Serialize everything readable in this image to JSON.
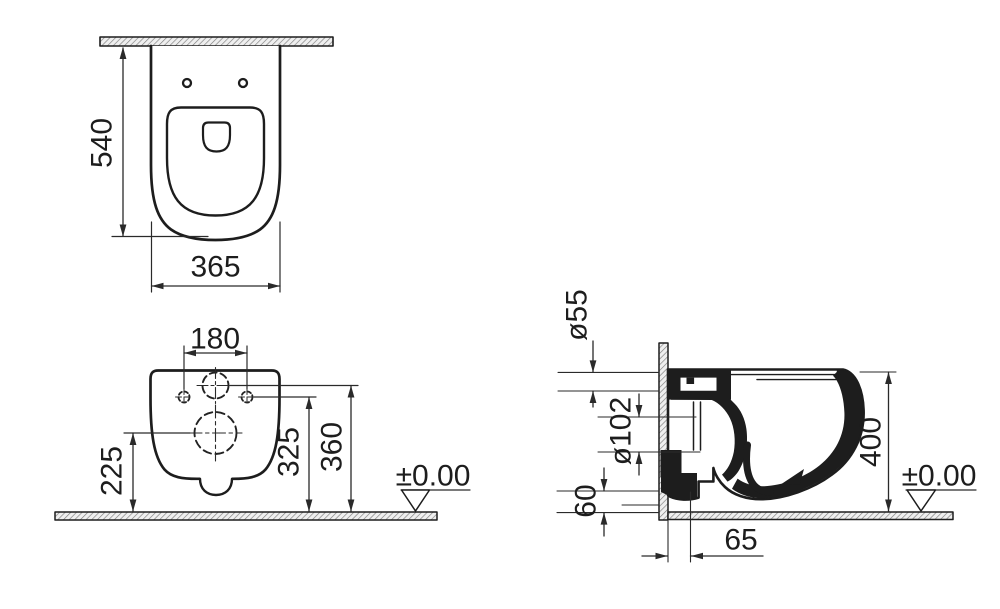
{
  "drawing": {
    "type": "technical-dimension-drawing",
    "subject": "wall-hung-toilet",
    "line_color": "#1d1d1d",
    "views": {
      "top_view": {
        "depth": "540",
        "width": "365"
      },
      "front_view": {
        "fixing_holes_spacing": "180",
        "outlet_center_height": "225",
        "fixing_holes_height": "325",
        "water_inlet_height": "360",
        "floor_level": "±0.00"
      },
      "side_view": {
        "water_inlet_diameter": "ø55",
        "outlet_diameter": "ø102",
        "outlet_bottom_height": "60",
        "overall_height": "400",
        "outlet_wall_distance": "65",
        "floor_level": "±0.00"
      }
    }
  }
}
